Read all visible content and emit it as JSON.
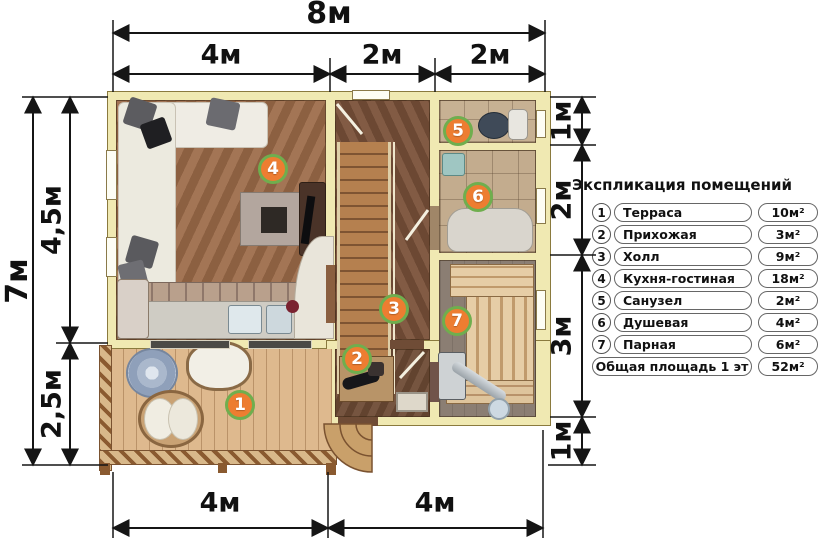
{
  "dims": {
    "top_total": "8м",
    "top_segs": [
      "4м",
      "2м",
      "2м"
    ],
    "left_total": "7м",
    "left_segs": [
      "4,5м",
      "2,5м"
    ],
    "right_segs": [
      "1м",
      "2м",
      "3м",
      "1м"
    ],
    "bottom_segs": [
      "4м",
      "4м"
    ]
  },
  "badges": [
    "1",
    "2",
    "3",
    "4",
    "5",
    "6",
    "7"
  ],
  "legend": {
    "title": "Экспликация помещений",
    "rows": [
      {
        "num": "1",
        "name": "Терраса",
        "area": "10м²"
      },
      {
        "num": "2",
        "name": "Прихожая",
        "area": "3м²"
      },
      {
        "num": "3",
        "name": "Холл",
        "area": "9м²"
      },
      {
        "num": "4",
        "name": "Кухня-гостиная",
        "area": "18м²"
      },
      {
        "num": "5",
        "name": "Санузел",
        "area": "2м²"
      },
      {
        "num": "6",
        "name": "Душевая",
        "area": "4м²"
      },
      {
        "num": "7",
        "name": "Парная",
        "area": "6м²"
      }
    ],
    "total_label": "Общая площадь 1 эт",
    "total_area": "52м²"
  },
  "colors": {
    "badge_fill": "#ed7d31",
    "badge_ring": "#6fae4e",
    "wall": "#f0e9b2"
  }
}
